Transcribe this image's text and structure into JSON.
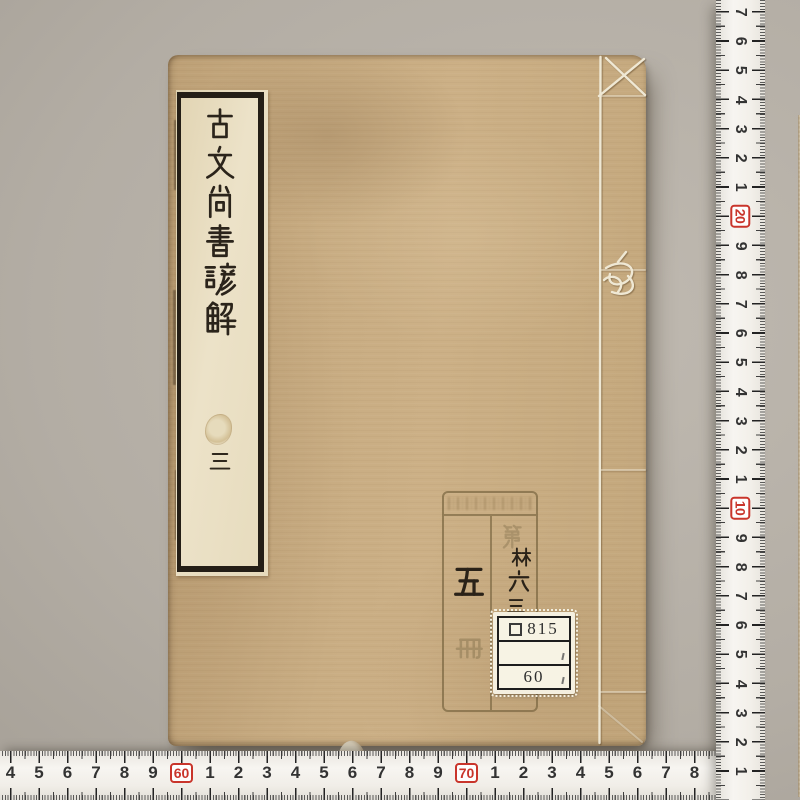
{
  "book": {
    "title_slip": {
      "title": "古文尚書諺解",
      "volume": "三"
    },
    "stamp": {
      "header_text": "illegible",
      "volume_count": "五",
      "volume_count_faint": "冊",
      "shelf_mark_faint": "第",
      "shelf_mark_1": "林",
      "shelf_mark_2": "六",
      "shelf_mark_3": "三"
    },
    "call_number_label": {
      "line1_prefix": "ロ",
      "line1_number": "815",
      "line2": "",
      "line3": "60"
    }
  },
  "rulers": {
    "right_vertical": {
      "unit": "cm",
      "numbers_top_to_bottom": [
        "7",
        "6",
        "5",
        "4",
        "3",
        "2",
        "1",
        "20",
        "9",
        "8",
        "7",
        "6",
        "5",
        "4",
        "3",
        "2",
        "1",
        "10",
        "9",
        "8",
        "7",
        "6",
        "5",
        "4",
        "3",
        "2",
        "1"
      ],
      "highlight_numbers": [
        "20",
        "10"
      ],
      "brand_marks": [
        "JAPAN",
        "TAJIMA",
        "1m"
      ]
    },
    "bottom_horizontal": {
      "unit": "cm",
      "numbers_left_to_right": [
        "4",
        "5",
        "6",
        "7",
        "8",
        "9",
        "60",
        "1",
        "2",
        "3",
        "4",
        "5",
        "6",
        "7",
        "8",
        "9",
        "70",
        "1",
        "2",
        "3",
        "4",
        "5",
        "6",
        "7",
        "8"
      ],
      "highlight_numbers": [
        "60",
        "70"
      ]
    }
  },
  "colors": {
    "background": "#b3ada4",
    "book_cover": "#c6aa80",
    "slip_paper": "#eadfc4",
    "slip_frame": "#241e16",
    "ink": "#2a2218",
    "stamp_ink": "#82704c",
    "tape_white": "#f3f1ec",
    "tape_red": "#c9352b",
    "label_paper": "#f4efdf"
  }
}
